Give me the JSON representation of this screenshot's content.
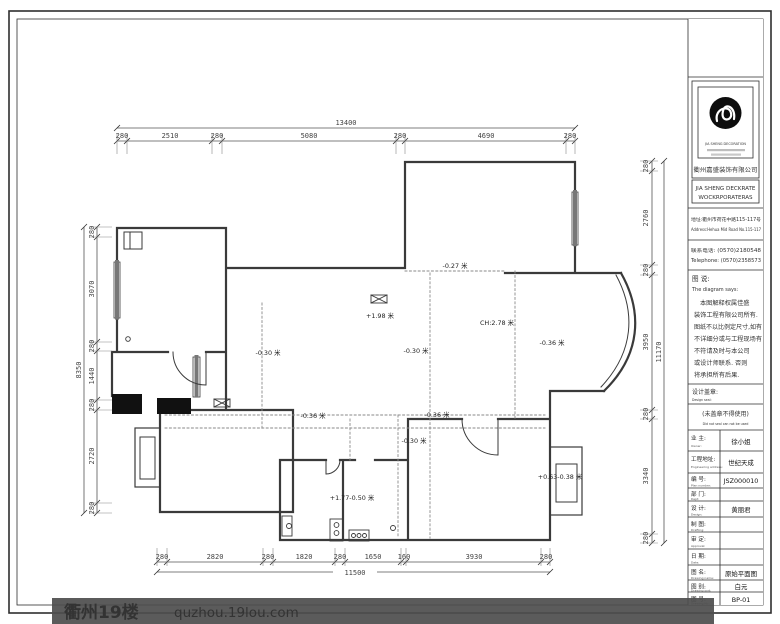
{
  "dims": {
    "top": {
      "total": "13400",
      "segments": [
        "280",
        "2510",
        "280",
        "5080",
        "280",
        "4690",
        "280"
      ]
    },
    "left": {
      "total": "8350",
      "segments": [
        "280",
        "3070",
        "280",
        "1440",
        "280",
        "2720",
        "280"
      ]
    },
    "right": {
      "total": "11170",
      "segments": [
        "280",
        "2760",
        "280",
        "3950",
        "280",
        "3340",
        "280"
      ]
    },
    "bottom": {
      "total": "11500",
      "segments": [
        "280",
        "2820",
        "280",
        "1820",
        "280",
        "1650",
        "160",
        "3930",
        "280"
      ]
    }
  },
  "plan_labels": {
    "elevations": [
      "-0.27 米",
      "+1.98 米",
      "CH:2.78 米",
      "-0.30 米",
      "-0.30 米",
      "-0.36 米",
      "-0.36 米",
      "-0.36 米",
      "-0.30 米",
      "+1.77-0.50 米",
      "+0.63-0.38 米"
    ]
  },
  "title_block": {
    "company": {
      "logo_caption": "JIA SHENG DECORATION",
      "name_cn": "衢州嘉盛装饰有限公司",
      "name_en_line1": "JIA SHENG DECKRATE",
      "name_en_line2": "WOCKRPORATERAS"
    },
    "contact": {
      "address_cn": "地址:衢州市荷花中路115-117号",
      "address_en": "Address:Hehua Mid Road No.115-117",
      "phone_cn": "联系电话: (0570)2180548",
      "phone_en": "Telephone: (0570)2358573"
    },
    "notes": {
      "heading_cn": "图 说:",
      "heading_en": "The diagram says:",
      "lines": [
        "本图解释权属佳盛",
        "装饰工程有限公司所有.",
        "图纸不以比例定尺寸,如有",
        "不详细分或与工程现场有",
        "不符请及时与本公司",
        "或设计师联系. 否则",
        "将承担所有后果."
      ],
      "seal_cn": "设计盖章:",
      "seal_en": "Design seal:",
      "seal_warn_cn": "(未盖章不得使用)",
      "seal_warn_en": "Did not seal can not be used"
    },
    "rows": [
      {
        "label": "业 主:",
        "en": "Owner:",
        "value": "徐小姐"
      },
      {
        "label": "工程地址:",
        "en": "Engineering address:",
        "value": "世纪天成"
      },
      {
        "label": "编 号:",
        "en": "Plan number:",
        "value": "JSZ000010"
      },
      {
        "label": "部 门:",
        "en": "Dept:",
        "value": ""
      },
      {
        "label": "设 计:",
        "en": "Design:",
        "value": "黄丽君"
      },
      {
        "label": "制 图:",
        "en": "Drafting:",
        "value": ""
      },
      {
        "label": "审 定:",
        "en": "Approval:",
        "value": ""
      },
      {
        "label": "日 期:",
        "en": "Date:",
        "value": ""
      },
      {
        "label": "图 名:",
        "en": "Drawing name:",
        "value": "原始平面图"
      },
      {
        "label": "图 别:",
        "en": "Drawing sort:",
        "value": "白元"
      },
      {
        "label": "图 号:",
        "en": "Drawing No.:",
        "value": "BP-01"
      }
    ]
  },
  "watermark": {
    "site_name": "衢州19楼",
    "site_url": "quzhou.19lou.com"
  },
  "colors": {
    "wall": "#3a3a3a",
    "dim": "#444444",
    "watermark_bar": "#4d4d4d",
    "watermark_text": "#b0b0b0",
    "watermark_url": "#7e91ad"
  }
}
